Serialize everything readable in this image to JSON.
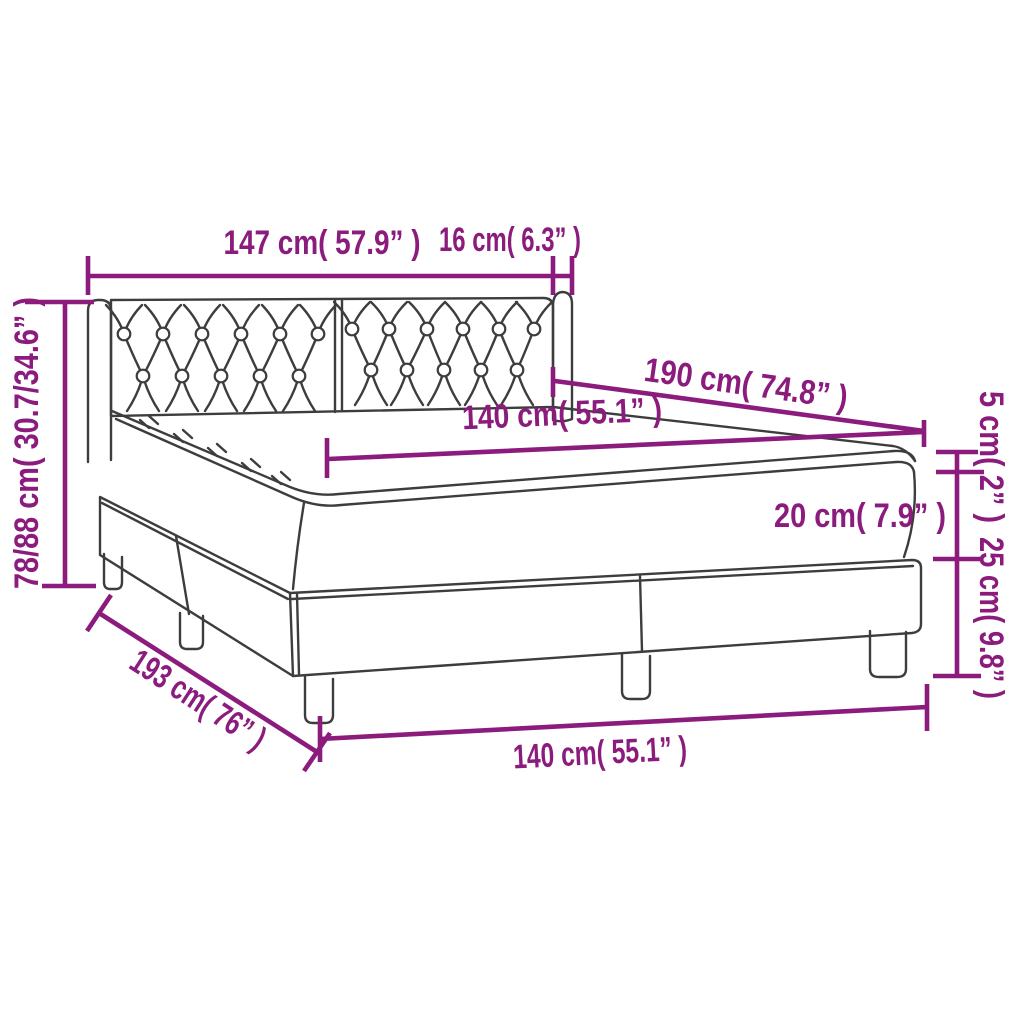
{
  "diagram": {
    "description": "Box spring bed with tufted headboard - dimension diagram",
    "accent_color": "#8b1b7d",
    "line_color": "#3d3d3d",
    "background_color": "#ffffff",
    "dimensions": {
      "headboard_width": "147 cm( 57.9” )",
      "headboard_side_depth": "16 cm( 6.3” )",
      "overall_height": "78/88 cm( 30.7/34.6” )",
      "bed_length_top": "190 cm( 74.8” )",
      "mattress_width_top": "140 cm( 55.1” )",
      "topper_height": "5 cm( 2” )",
      "mattress_height": "20 cm( 7.9” )",
      "base_height": "25 cm( 9.8” )",
      "bed_length_side": "193 cm( 76” )",
      "bed_width_bottom": "140 cm( 55.1” )"
    }
  }
}
